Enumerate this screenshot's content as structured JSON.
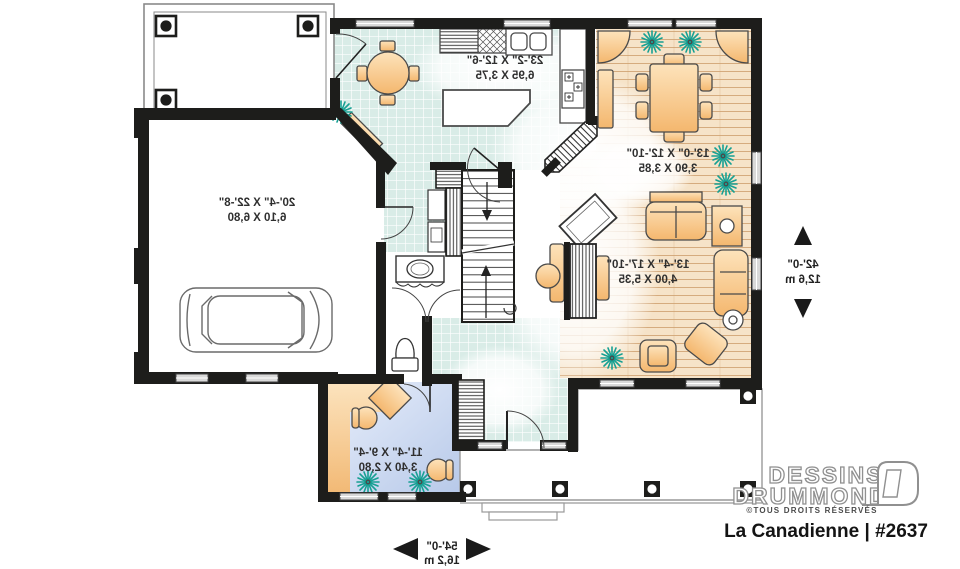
{
  "branding": {
    "line1": "DESSINS",
    "line2": "DRUMMOND",
    "rights": "©TOUS DROITS RÉSERVÉS",
    "plan_label": "La Canadienne | #2637"
  },
  "rooms": {
    "garage": {
      "imperial": "20'-4\" X 22'-8\"",
      "metric": "6,10 X 6,80"
    },
    "kitchen": {
      "imperial": "23'-2\" X 12'-6\"",
      "metric": "6,95 X 3,75"
    },
    "dining": {
      "imperial": "13'-0\" X 12'-10\"",
      "metric": "3,90 X 3,85"
    },
    "living": {
      "imperial": "13'-4\" X 17'-10\"",
      "metric": "4,00 X 5,35"
    },
    "office": {
      "imperial": "11'-4\" X 9'-4\"",
      "metric": "3,40 X 2,80"
    }
  },
  "dims": {
    "depth": {
      "imperial": "42'-0\"",
      "metric": "12,6 m"
    },
    "width": {
      "imperial": "54'-0\"",
      "metric": "16,2 m"
    }
  },
  "colors": {
    "wall": "#1d1d1b",
    "tile": "#d9ece7",
    "wood": "#f6e3c8",
    "office_floor": "#b7c9e9",
    "furniture": "#f4b76e",
    "plant": "#16a093",
    "logo_gray": "#909090"
  }
}
